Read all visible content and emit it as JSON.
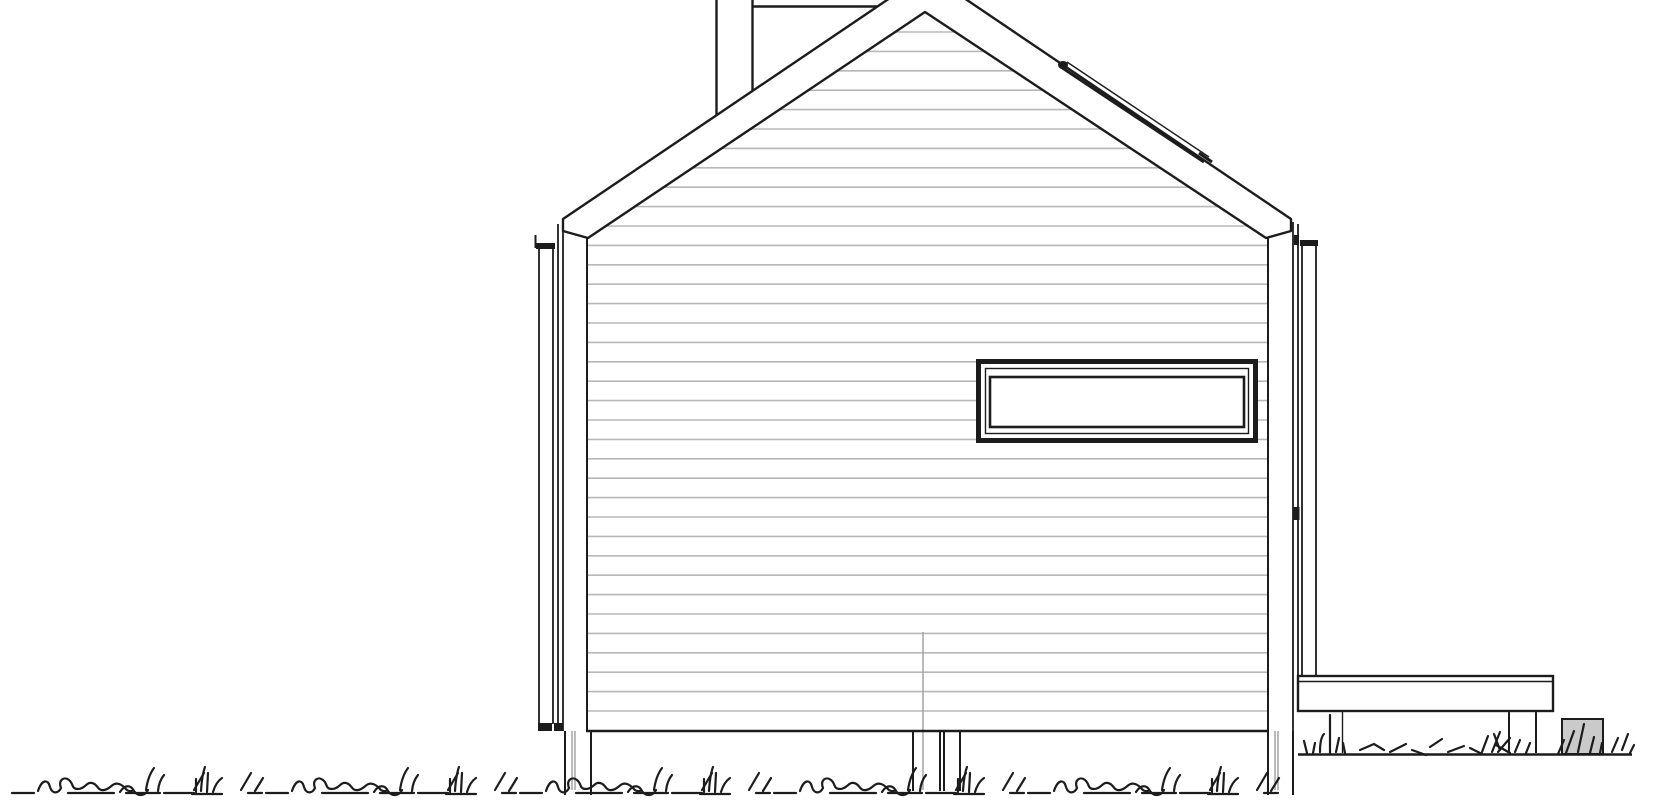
{
  "document": {
    "kind": "architectural-elevation-drawing",
    "style": "black line work on white, CAD elevation",
    "description": "Side (gable-end) elevation of a small pitched-roof cabin raised on posts, with horizontal lap siding, corner trim boards, a wide horizontal ribbon window, a flue behind the ridge, a skylight edge strip on the right roof slope, an attached deck to the right, a landscape block, and grass tufts along two ground lines."
  },
  "colors": {
    "background": "#ffffff",
    "line": "#1c1c1c",
    "siding_line": "#b8b8b8",
    "soft_gray": "#9e9e9e",
    "block_fill": "#cacaca"
  },
  "components": {
    "roof": {
      "apex_x": 927,
      "left_eave": [
        563,
        219
      ],
      "right_eave": [
        1291,
        219
      ],
      "fascia_band": true
    },
    "chimney_flue": {
      "left_line_x": 716.5,
      "right_line_x": 752.5,
      "top_rail_y": 6.5,
      "rail_end_x": 878
    },
    "skylight_strip": {
      "from": [
        1061,
        66
      ],
      "to": [
        1209,
        162
      ]
    },
    "wall": {
      "left_x": 587,
      "right_x": 1268,
      "bottom_y": 731,
      "gable_peak": [
        925,
        12
      ]
    },
    "window": {
      "outer_box": [
        976,
        359,
        282,
        84
      ],
      "frames": 3
    },
    "deck": {
      "box": [
        1298,
        676,
        255,
        35
      ],
      "posts_x": [
        1342,
        1509,
        1536
      ]
    },
    "foundation_posts": [
      {
        "x1": 565,
        "x2": 591
      },
      {
        "x1": 913,
        "x2": 960
      },
      {
        "x1": 1268,
        "x2": 1293
      }
    ],
    "landscape_block": {
      "box": [
        1562,
        719,
        41,
        35
      ]
    },
    "ground_back": {
      "y": 754.5,
      "x1": 1298,
      "x2": 1632
    },
    "ground_front": {
      "baseline_y": 792
    }
  },
  "siding": {
    "first_line_y": 32,
    "line_spacing": 19.4,
    "line_count": 36,
    "left_x": 556,
    "right_x": 1292
  },
  "center_joint": {
    "x": 923,
    "y1": 632,
    "y2": 790
  },
  "grass_foreground": {
    "unit_offsets": [
      8,
      262,
      516,
      770,
      1024
    ]
  }
}
